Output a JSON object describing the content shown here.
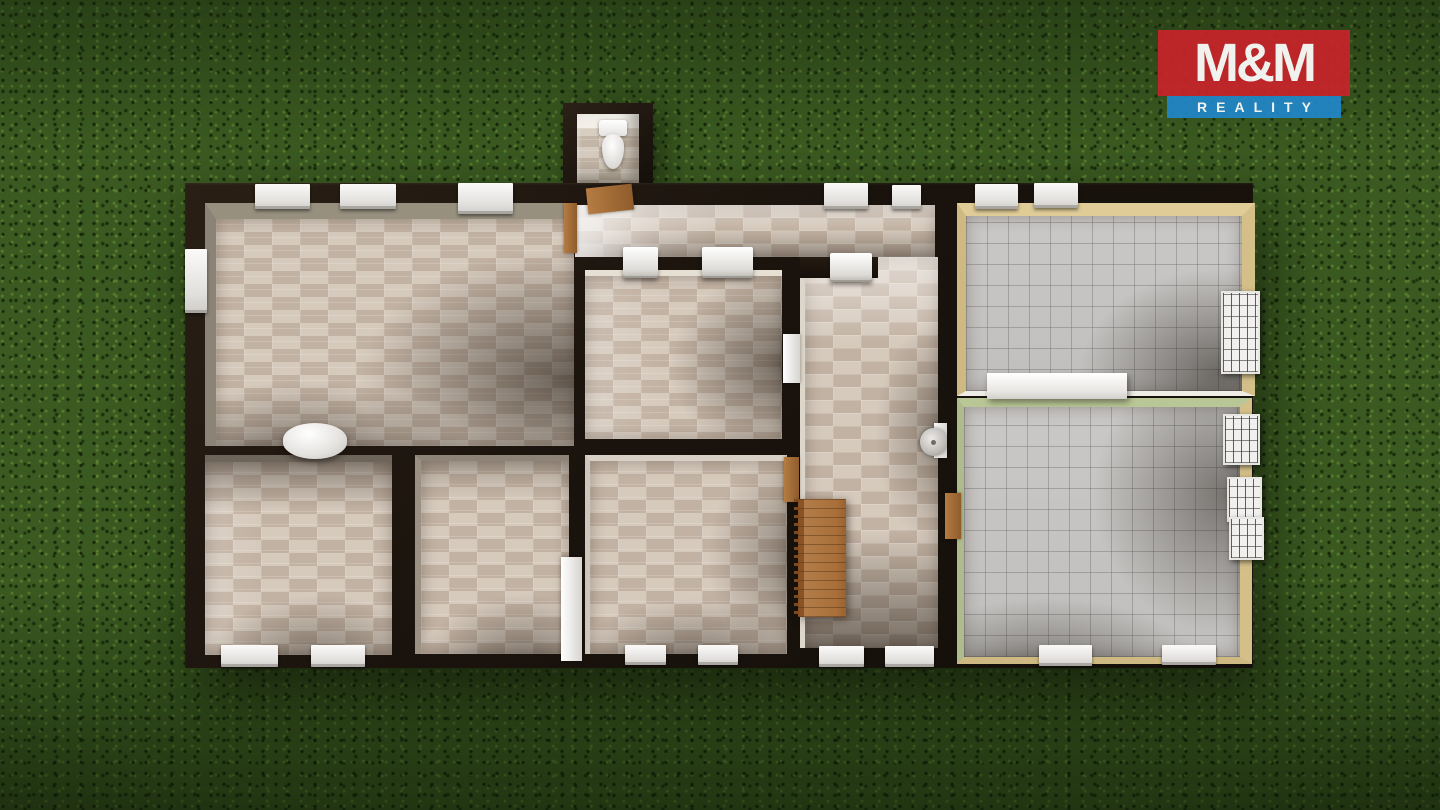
{
  "brand": {
    "name": "M&M REALITY",
    "line1": "M&M",
    "line2": "REALITY",
    "colors": {
      "red": "#c8242a",
      "blue": "#2186c8",
      "text": "#ffffff"
    }
  },
  "scene": {
    "type": "3d-floor-plan-render",
    "view": "top-down",
    "background": "grass-lawn",
    "building_outline": "rectangular-with-wc-annex"
  },
  "palette": {
    "grass": "#3b5a21",
    "exterior_walls": "#1e1611",
    "beige_tile": "#d6cabd",
    "beige_tile_alt": "#c2b2a3",
    "gray_tile": "#c7c5c3",
    "tan_wall_face": "#ddc993",
    "green_wall_face": "#b9c695",
    "wood": "#a97440",
    "white_fixture": "#f3f2f0"
  },
  "rooms": [
    {
      "id": "wc-annex",
      "floor": "beige-tile",
      "fixtures": [
        "toilet",
        "wood-door"
      ]
    },
    {
      "id": "top-hallway",
      "floor": "beige-tile",
      "fixtures": [
        "wood-door-frame"
      ]
    },
    {
      "id": "stair-hall",
      "floor": "beige-tile",
      "fixtures": [
        "staircase",
        "wash-basin",
        "wood-door",
        "wood-door"
      ]
    },
    {
      "id": "room-top-left",
      "floor": "beige-brick-tile",
      "fixtures": [
        "stove-cylinder"
      ]
    },
    {
      "id": "room-center",
      "floor": "beige-brick-tile",
      "fixtures": [
        "radiator",
        "radiator",
        "white-door"
      ]
    },
    {
      "id": "room-top-right",
      "floor": "gray-tile",
      "wall_faces": "tan",
      "fixtures": [
        "white-sideboard"
      ]
    },
    {
      "id": "room-bottom-right",
      "floor": "gray-tile",
      "wall_faces": "green-and-tan",
      "fixtures": []
    },
    {
      "id": "room-bottom-left-1",
      "floor": "beige-brick-tile",
      "fixtures": []
    },
    {
      "id": "room-bottom-left-2",
      "floor": "beige-brick-tile",
      "fixtures": [
        "white-door"
      ]
    },
    {
      "id": "room-bottom-center",
      "floor": "beige-brick-tile",
      "fixtures": []
    }
  ],
  "openings": {
    "windows_top_wall": 7,
    "windows_bottom_wall": 8,
    "windows_left_wall": 1,
    "windows_right_wall_gridded": 4,
    "white_interior_doors": 2,
    "wood_doors": 4
  }
}
